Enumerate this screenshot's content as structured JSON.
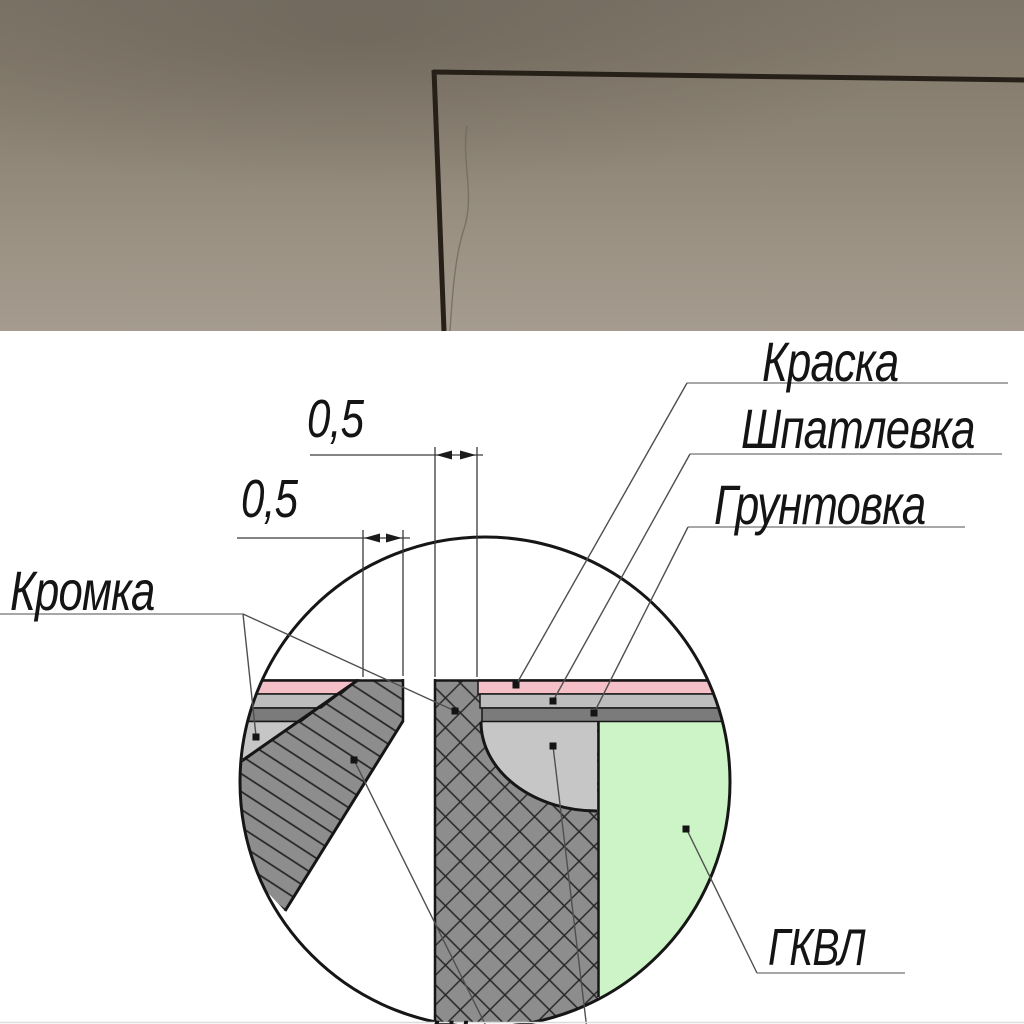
{
  "photo": {
    "colors": {
      "wall_top": "#7e7669",
      "wall_bottom": "#a59c8f",
      "joint_line": "#262019"
    }
  },
  "diagram": {
    "labels": {
      "paint": "Краска",
      "putty": "Шпатлевка",
      "primer": "Грунтовка",
      "edge": "Кромка",
      "board": "ГКВЛ",
      "bottom_partial": "Шпатлевка"
    },
    "dimensions": {
      "upper": "0,5",
      "lower": "0,5"
    },
    "colors": {
      "paint_layer": "#f5bfc8",
      "putty_layer": "#bdbdbd",
      "primer_layer": "#7b7b7b",
      "joint_filler": "#c6c6c6",
      "board_hatch_bg": "#8d8d8d",
      "gkvl_green": "#ccf4c6",
      "outline": "#161616"
    }
  }
}
